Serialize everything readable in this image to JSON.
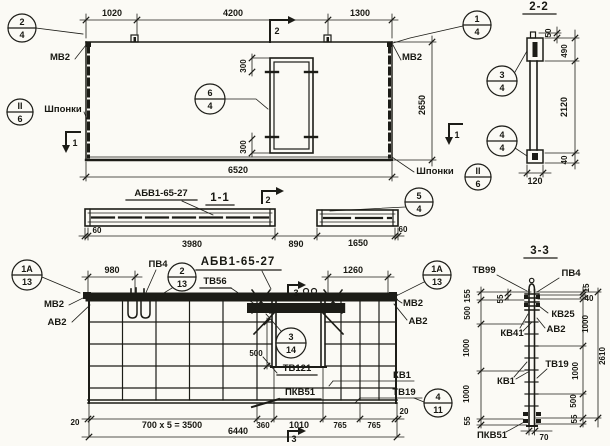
{
  "ele": {
    "d1020": "1020",
    "d4200": "4200",
    "d1300": "1300",
    "d6520": "6520",
    "d2650": "2650",
    "d300t": "300",
    "d300b": "300",
    "mv2l": "МВ2",
    "mv2r": "МВ2",
    "shpl": "Шпонки",
    "shpr": "Шпонки",
    "c24t": "2",
    "c24b": "4",
    "c14t": "1",
    "c14b": "4",
    "c64t": "6",
    "c64b": "4",
    "ciilt": "II",
    "ciilb": "6",
    "ciirt": "II",
    "ciirb": "6",
    "m1l": "1",
    "m1r": "1",
    "m2t": "2",
    "m2b": "2"
  },
  "s11": {
    "label": "АБВ1-65-27",
    "title": "1-1",
    "d60l": "60",
    "d3980": "3980",
    "d890": "890",
    "d1650": "1650",
    "d60r": "60",
    "c54t": "5",
    "c54b": "4"
  },
  "s22": {
    "title": "2-2",
    "d50": "50",
    "d490": "490",
    "d2120": "2120",
    "d40": "40",
    "d120": "120",
    "c34t": "3",
    "c34b": "4",
    "c44t": "4",
    "c44b": "4"
  },
  "plan": {
    "title": "АБВ1-65-27",
    "d980": "980",
    "d1260": "1260",
    "d500": "500",
    "d20l": "20",
    "d3500": "700 x 5 = 3500",
    "d360": "360",
    "d1010": "1010",
    "d765a": "765",
    "d765b": "765",
    "d20r": "20",
    "d6440": "6440",
    "pv4": "ПВ4",
    "tv56": "ТВ56",
    "mv2l": "МВ2",
    "av2l": "АВ2",
    "mv2r": "МВ2",
    "av2r": "АВ2",
    "tv121": "ТВ121",
    "kv1": "КВ1",
    "pkv51": "ПКВ51",
    "tv19": "ТВ19",
    "c1alt": "1А",
    "c1alb": "13",
    "c213t": "2",
    "c213b": "13",
    "c1art": "1А",
    "c1arb": "13",
    "c314t": "3",
    "c314b": "14",
    "c411t": "4",
    "c411b": "11",
    "m3t": "3",
    "m3b": "3"
  },
  "s33": {
    "title": "3-3",
    "tv99": "ТВ99",
    "pv4": "ПВ4",
    "kv25": "КВ25",
    "av2": "АВ2",
    "kv41": "КВ41",
    "kv1": "КВ1",
    "tv19": "ТВ19",
    "pkv51": "ПКВ51",
    "d155": "155",
    "d55s": "55",
    "d500l": "500",
    "d1000la": "1000",
    "d1000lb": "1000",
    "d55lb": "55",
    "d15": "15",
    "d40": "40",
    "d1000ra": "1000",
    "d1000rb": "1000",
    "d500r": "500",
    "d55r": "55",
    "d2610": "2610",
    "d70": "70"
  }
}
